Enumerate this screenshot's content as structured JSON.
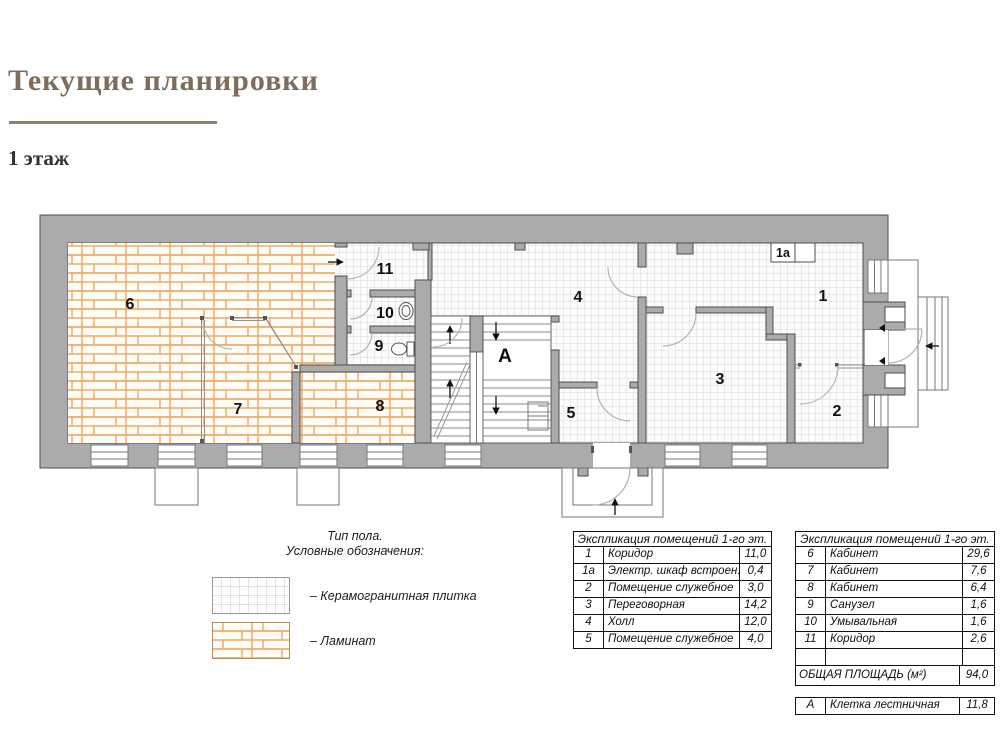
{
  "page": {
    "title": "Текущие планировки",
    "floor_label": "1 этаж"
  },
  "colors": {
    "wall": "#ababab",
    "laminate_line": "#efa55c",
    "tile_line": "#d8d8d8",
    "title": "#7d6d5a"
  },
  "legend": {
    "title_line1": "Тип пола.",
    "title_line2": "Условные обозначения:",
    "tile_label": "– Керамогранитная плитка",
    "laminate_label": "– Ламинат"
  },
  "plan": {
    "labels": {
      "r1": "1",
      "r1a": "1a",
      "r2": "2",
      "r3": "3",
      "r4": "4",
      "r5": "5",
      "r6": "6",
      "r7": "7",
      "r8": "8",
      "r9": "9",
      "r10": "10",
      "r11": "11",
      "stair": "А"
    }
  },
  "tables": {
    "left": {
      "header": "Экспликация помещений 1-го эт.",
      "rows": [
        [
          "1",
          "Коридор",
          "11,0"
        ],
        [
          "1а",
          "Электр. шкаф встроен.",
          "0,4"
        ],
        [
          "2",
          "Помещение служебное",
          "3,0"
        ],
        [
          "3",
          "Переговорная",
          "14,2"
        ],
        [
          "4",
          "Холл",
          "12,0"
        ],
        [
          "5",
          "Помещение служебное",
          "4,0"
        ]
      ]
    },
    "right": {
      "header": "Экспликация помещений 1-го эт.",
      "rows": [
        [
          "6",
          "Кабинет",
          "29,6"
        ],
        [
          "7",
          "Кабинет",
          "7,6"
        ],
        [
          "8",
          "Кабинет",
          "6,4"
        ],
        [
          "9",
          "Санузел",
          "1,6"
        ],
        [
          "10",
          "Умывальная",
          "1,6"
        ],
        [
          "11",
          "Коридор",
          "2,6"
        ],
        [
          "",
          "",
          ""
        ]
      ],
      "total_label": "ОБЩАЯ ПЛОЩАДЬ (м²)",
      "total_value": "94,0"
    },
    "stair_row": {
      "num": "А",
      "name": "Клетка лестничная",
      "value": "11,8"
    }
  }
}
